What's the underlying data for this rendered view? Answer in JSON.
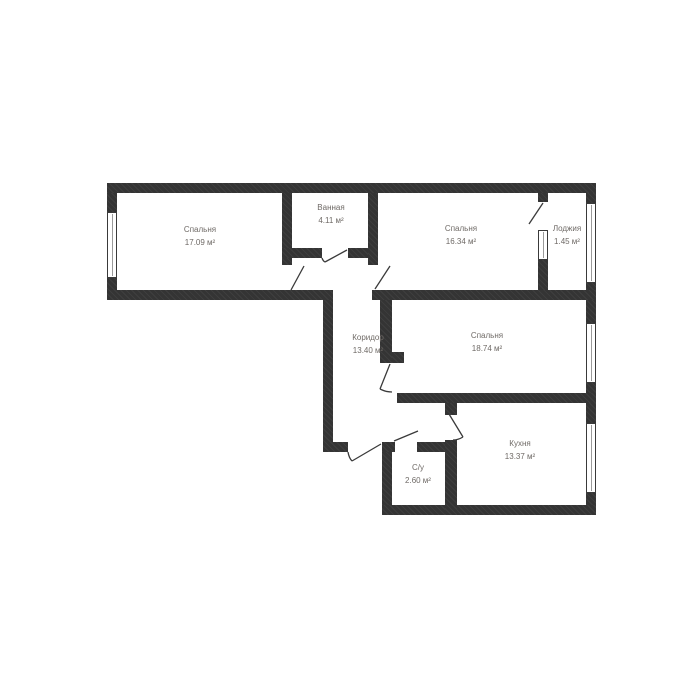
{
  "plan": {
    "title": "apartment-floor-plan",
    "colors": {
      "background": "#ffffff",
      "wall": "#3a3a3a",
      "wall_hatch": "#343434",
      "door_line": "#3a3a3a",
      "window_frame": "#3a3a3a",
      "window_pane": "#9a9a9a",
      "label_text": "#6f6a66"
    },
    "rooms": [
      {
        "id": "bedroom-1",
        "name": "Спальня",
        "area": "17.09 м²",
        "cx": 200,
        "cy": 236
      },
      {
        "id": "bathroom",
        "name": "Ванная",
        "area": "4.11 м²",
        "cx": 331,
        "cy": 214
      },
      {
        "id": "bedroom-2",
        "name": "Спальня",
        "area": "16.34 м²",
        "cx": 461,
        "cy": 235
      },
      {
        "id": "loggia",
        "name": "Лоджия",
        "area": "1.45 м²",
        "cx": 567,
        "cy": 235
      },
      {
        "id": "corridor",
        "name": "Коридор",
        "area": "13.40 м²",
        "cx": 368,
        "cy": 344
      },
      {
        "id": "bedroom-3",
        "name": "Спальня",
        "area": "18.74 м²",
        "cx": 487,
        "cy": 342
      },
      {
        "id": "kitchen",
        "name": "Кухня",
        "area": "13.37 м²",
        "cx": 520,
        "cy": 450
      },
      {
        "id": "wc",
        "name": "С/у",
        "area": "2.60 м²",
        "cx": 418,
        "cy": 474
      }
    ],
    "walls": [
      {
        "id": "outer-top",
        "x": 107,
        "y": 183,
        "w": 489,
        "h": 10
      },
      {
        "id": "outer-left-upper",
        "x": 107,
        "y": 193,
        "w": 10,
        "h": 19
      },
      {
        "id": "outer-left-lower",
        "x": 107,
        "y": 278,
        "w": 10,
        "h": 22
      },
      {
        "id": "section1-bottom",
        "x": 107,
        "y": 290,
        "w": 226,
        "h": 10
      },
      {
        "id": "corridor-left",
        "x": 323,
        "y": 300,
        "w": 10,
        "h": 152
      },
      {
        "id": "corridor-bottom",
        "x": 323,
        "y": 442,
        "w": 25,
        "h": 10
      },
      {
        "id": "wc-left",
        "x": 382,
        "y": 442,
        "w": 10,
        "h": 63
      },
      {
        "id": "outer-bottom",
        "x": 382,
        "y": 505,
        "w": 214,
        "h": 10
      },
      {
        "id": "outer-right-seg1",
        "x": 586,
        "y": 193,
        "w": 10,
        "h": 10
      },
      {
        "id": "outer-right-seg2",
        "x": 586,
        "y": 283,
        "w": 10,
        "h": 40
      },
      {
        "id": "outer-right-seg3",
        "x": 586,
        "y": 383,
        "w": 10,
        "h": 40
      },
      {
        "id": "outer-right-seg4",
        "x": 586,
        "y": 493,
        "w": 10,
        "h": 12
      },
      {
        "id": "bathroom-left",
        "x": 282,
        "y": 193,
        "w": 10,
        "h": 72
      },
      {
        "id": "bathroom-bottom-l",
        "x": 282,
        "y": 248,
        "w": 40,
        "h": 10
      },
      {
        "id": "bathroom-bottom-r",
        "x": 348,
        "y": 248,
        "w": 30,
        "h": 10
      },
      {
        "id": "bathroom-right",
        "x": 368,
        "y": 193,
        "w": 10,
        "h": 72
      },
      {
        "id": "section2-bottom",
        "x": 372,
        "y": 290,
        "w": 224,
        "h": 10
      },
      {
        "id": "loggia-divider-top",
        "x": 538,
        "y": 193,
        "w": 10,
        "h": 9
      },
      {
        "id": "loggia-divider-low",
        "x": 538,
        "y": 260,
        "w": 10,
        "h": 30
      },
      {
        "id": "bedroom3-left",
        "x": 380,
        "y": 300,
        "w": 12,
        "h": 63
      },
      {
        "id": "bedroom3-notch",
        "x": 392,
        "y": 352,
        "w": 12,
        "h": 11
      },
      {
        "id": "bedroom3-bottom",
        "x": 397,
        "y": 393,
        "w": 199,
        "h": 10
      },
      {
        "id": "wc-top-left",
        "x": 382,
        "y": 442,
        "w": 13,
        "h": 10
      },
      {
        "id": "wc-top-right",
        "x": 417,
        "y": 442,
        "w": 40,
        "h": 10
      },
      {
        "id": "kitchen-divider-stub",
        "x": 445,
        "y": 403,
        "w": 12,
        "h": 12
      },
      {
        "id": "kitchen-divider-low",
        "x": 445,
        "y": 440,
        "w": 12,
        "h": 75
      }
    ],
    "windows": [
      {
        "id": "window-bedroom-1",
        "x": 107,
        "y": 212,
        "w": 10,
        "h": 66
      },
      {
        "id": "window-loggia-divider",
        "x": 538,
        "y": 230,
        "w": 10,
        "h": 30
      },
      {
        "id": "window-loggia",
        "x": 586,
        "y": 203,
        "w": 10,
        "h": 80
      },
      {
        "id": "window-bedroom-3",
        "x": 586,
        "y": 323,
        "w": 10,
        "h": 60
      },
      {
        "id": "window-kitchen",
        "x": 586,
        "y": 423,
        "w": 10,
        "h": 70
      }
    ],
    "doors": [
      {
        "id": "door-bedroom-1",
        "path": "M291 290 L304 266"
      },
      {
        "id": "door-bathroom",
        "path": "M347 250 L325 262 M322 258 Q323 261 325 262"
      },
      {
        "id": "door-bedroom-2",
        "path": "M375 289 L390 266"
      },
      {
        "id": "door-loggia",
        "path": "M543 203 L529 224"
      },
      {
        "id": "door-bedroom-3",
        "path": "M390 364 L380 389 M380 389 Q386 392 392 392"
      },
      {
        "id": "door-entrance",
        "path": "M381 444 L352 461 M348 452 Q349 458 352 461"
      },
      {
        "id": "door-wc",
        "path": "M394 441 L418 431"
      },
      {
        "id": "door-kitchen",
        "path": "M449 414 L463 437 M463 437 Q458 440 453 440"
      }
    ]
  }
}
